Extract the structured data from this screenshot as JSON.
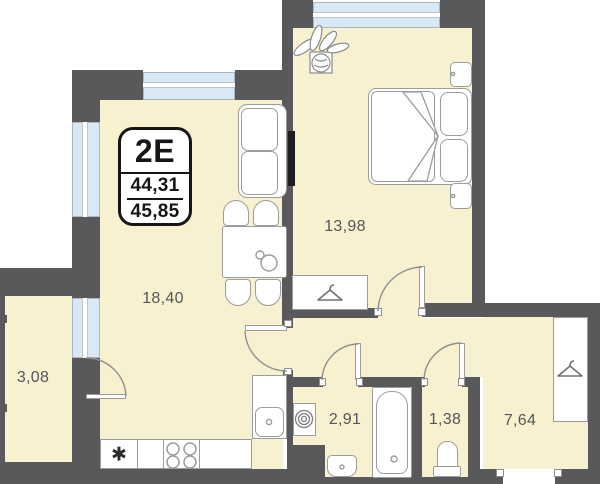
{
  "title": "Apartment floor plan 2E",
  "badge": {
    "type_label": "2E",
    "area_living": "44,31",
    "area_total": "45,85"
  },
  "rooms": {
    "living": {
      "name": "living-kitchen",
      "area": "18,40"
    },
    "bedroom": {
      "name": "bedroom",
      "area": "13,98"
    },
    "balcony": {
      "name": "balcony",
      "area": "3,08"
    },
    "bathroom": {
      "name": "bathroom",
      "area": "2,91"
    },
    "wc": {
      "name": "wc",
      "area": "1,38"
    },
    "hall": {
      "name": "hallway",
      "area": "7,64"
    }
  },
  "icons": {
    "fridge_symbol": "✱"
  },
  "colors": {
    "wall": "#59595c",
    "floor": "#f7f1cf",
    "window": "#d8e8f4",
    "line": "#9c9c9c",
    "label": "#54555b",
    "badge-ink": "#161616"
  }
}
